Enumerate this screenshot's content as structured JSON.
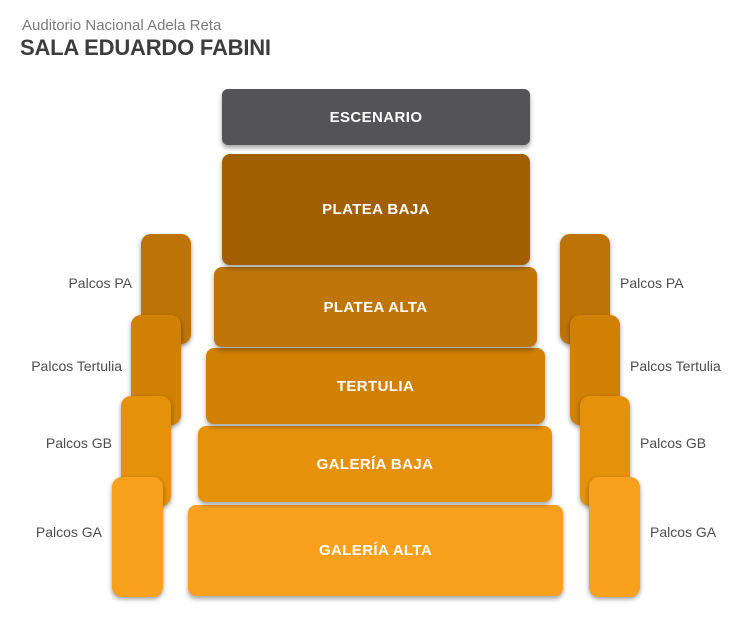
{
  "header": {
    "venue": "Auditorio Nacional Adela Reta",
    "hall": "SALA EDUARDO FABINI"
  },
  "stage": {
    "label": "ESCENARIO",
    "color": "#545457"
  },
  "sections": [
    {
      "id": "platea-baja",
      "label": "PLATEA BAJA",
      "color": "#a25f02"
    },
    {
      "id": "platea-alta",
      "label": "PLATEA ALTA",
      "color": "#bf7507"
    },
    {
      "id": "tertulia",
      "label": "TERTULIA",
      "color": "#d08104"
    },
    {
      "id": "galeria-baja",
      "label": "GALERÍA BAJA",
      "color": "#e5920a"
    },
    {
      "id": "galeria-alta",
      "label": "GALERÍA ALTA",
      "color": "#f9a01d"
    }
  ],
  "palcos": [
    {
      "id": "pa",
      "label": "Palcos PA",
      "color": "#bd7306"
    },
    {
      "id": "tertulia",
      "label": "Palcos Tertulia",
      "color": "#d08104"
    },
    {
      "id": "gb",
      "label": "Palcos GB",
      "color": "#e5920a"
    },
    {
      "id": "ga",
      "label": "Palcos GA",
      "color": "#f9a01d"
    }
  ],
  "colors": {
    "background": "#ffffff",
    "venue_text": "#7b7b7b",
    "hall_text": "#3d3d3d",
    "side_label_text": "#4d4d4d",
    "section_label_text": "#ffffff"
  }
}
